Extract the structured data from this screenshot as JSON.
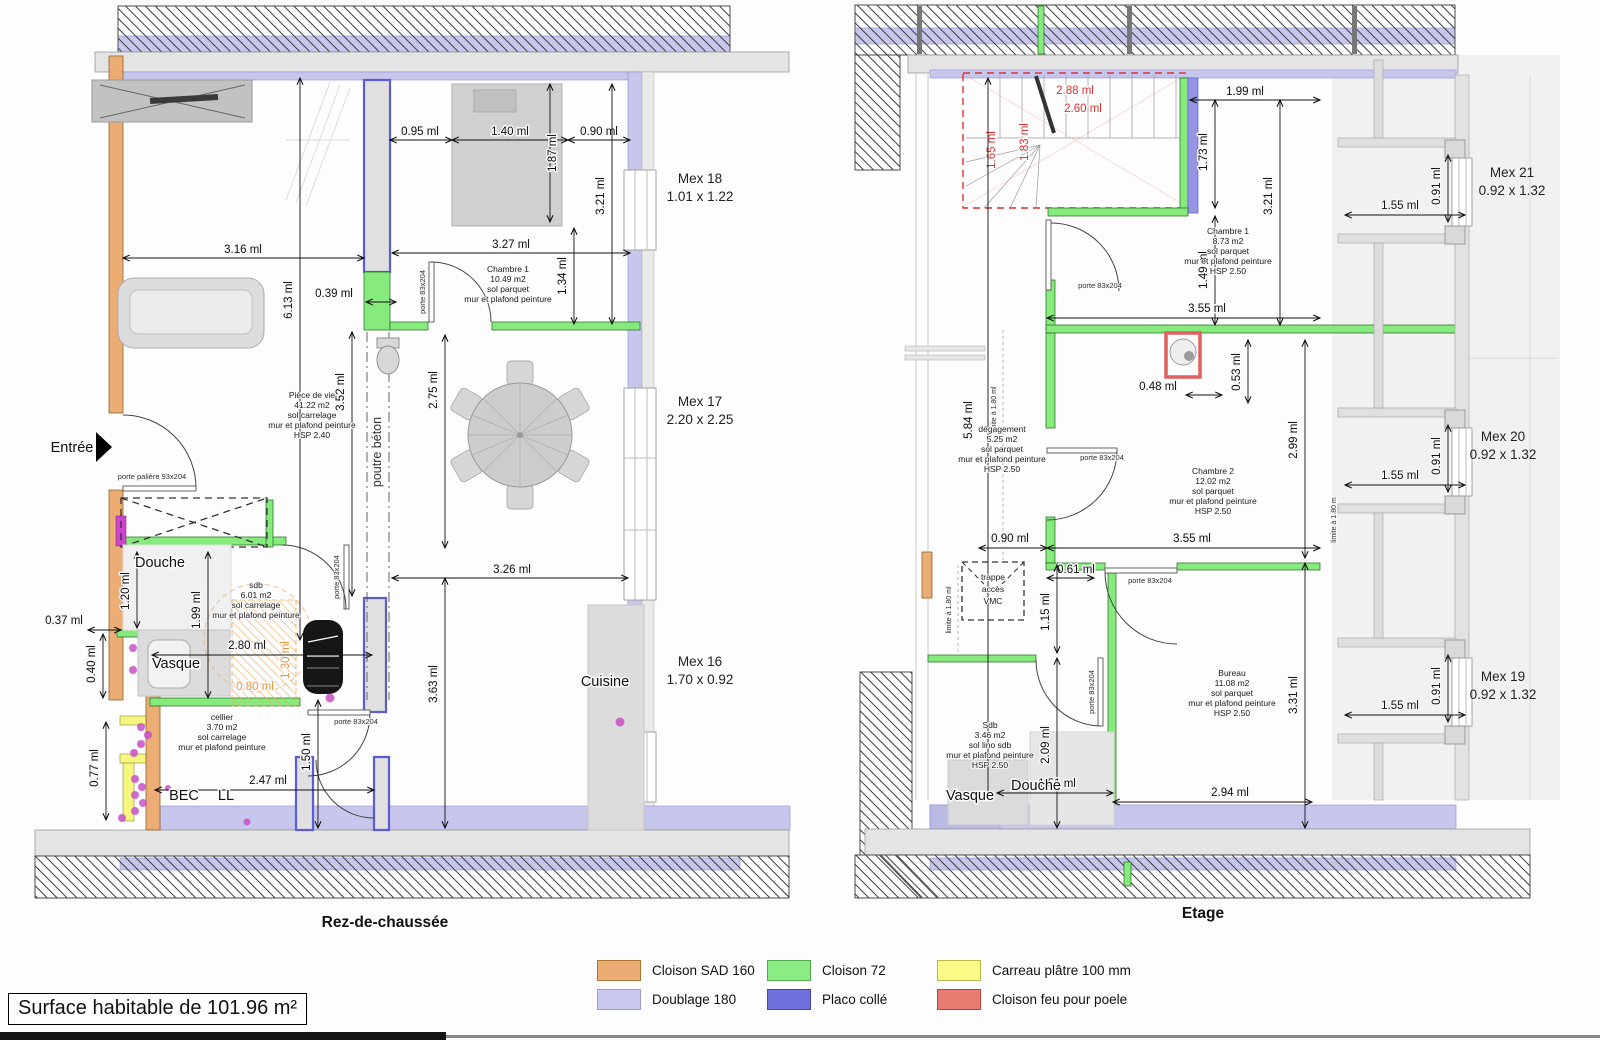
{
  "meta": {
    "surface_label": "Surface habitable de 101.96 m²"
  },
  "titles": {
    "ground": "Rez-de-chaussée",
    "floor": "Etage"
  },
  "legend": {
    "items": [
      {
        "label": "Cloison SAD 160",
        "color": "#EBAD74",
        "style": "background:#EBAD74;border:1px solid #A9772F"
      },
      {
        "label": "Doublage 180",
        "color": "#C9C9F0",
        "style": "background:#C9C9F0;border:1px solid #9B9BD0"
      },
      {
        "label": "Cloison 72",
        "color": "#8BEC83",
        "style": "background:#8BEC83;border:1px solid #4EA84E"
      },
      {
        "label": "Placo collé",
        "color": "#6F6FDE",
        "style": "background:#6F6FDE;border:1px solid #4444AA"
      },
      {
        "label": "Carreau plâtre 100 mm",
        "color": "#FAFA86",
        "style": "background:#FAFA86;border:1px solid #B9B950"
      },
      {
        "label": "Cloison feu pour poele",
        "color": "#E87B72",
        "style": "background:#E87B72;border:1px solid #B04840"
      }
    ]
  },
  "ground": {
    "labels": {
      "entree": "Entrée",
      "douche": "Douche",
      "vasque": "Vasque",
      "bec": "BEC",
      "ll": "LL",
      "cuisine": "Cuisine",
      "poutre": "poutre béton",
      "porte_paliere": "porte palière 93x204",
      "porte83": "porte 83x204"
    },
    "rooms": {
      "piece_de_vie": [
        "Pièce de vie",
        "41.22 m2",
        "sol carrelage",
        "mur et plafond peinture",
        "HSP 2.40"
      ],
      "chambre1": [
        "Chambre 1",
        "10.49 m2",
        "sol parquet",
        "mur et plafond peinture"
      ],
      "sdb": [
        "sdb",
        "6.01 m2",
        "sol carrelage",
        "mur et plafond peinture"
      ],
      "cellier": [
        "cellier",
        "3.70 m2",
        "sol carrelage",
        "mur et plafond peinture"
      ]
    },
    "windows": {
      "mex18": {
        "name": "Mex 18",
        "size": "1.01 x 1.22"
      },
      "mex17": {
        "name": "Mex 17",
        "size": "2.20 x 2.25"
      },
      "mex16": {
        "name": "Mex 16",
        "size": "1.70 x 0.92"
      }
    },
    "dims": {
      "d095": "0.95 ml",
      "d140": "1.40 ml",
      "d090": "0.90 ml",
      "d187": "1.87 ml",
      "d321": "3.21 ml",
      "d327": "3.27 ml",
      "d134": "1.34 ml",
      "d316": "3.16 ml",
      "d613": "6.13 ml",
      "d039": "0.39 ml",
      "d352": "3.52 ml",
      "d275": "2.75 ml",
      "d326": "3.26 ml",
      "d363": "3.63 ml",
      "d037": "0.37 ml",
      "d120": "1.20 ml",
      "d199": "1.99 ml",
      "d040": "0.40 ml",
      "d077": "0.77 ml",
      "d280": "2.80 ml",
      "d130": "1.30 ml",
      "d080": "0.80 ml",
      "d247": "2.47 ml",
      "d150": "1.50 ml"
    }
  },
  "floor": {
    "labels": {
      "vasque": "Vasque",
      "douche": "Douche",
      "porte83": "porte 83x204",
      "trappe1": "trappe",
      "trappe2": "accès",
      "trappe3": "VMC",
      "limite": "limite à 1.80 ml",
      "limite2": "limite à 1.80 m"
    },
    "rooms": {
      "chambre1": [
        "Chambre 1",
        "8.73 m2",
        "sol parquet",
        "mur et plafond peinture",
        "HSP 2.50"
      ],
      "degagement": [
        "dégagement",
        "5.25 m2",
        "sol parquet",
        "mur et plafond peinture",
        "HSP 2.50"
      ],
      "chambre2": [
        "Chambre 2",
        "12.02 m2",
        "sol parquet",
        "mur et plafond peinture",
        "HSP 2.50"
      ],
      "bureau": [
        "Bureau",
        "11.08 m2",
        "sol parquet",
        "mur et plafond peinture",
        "HSP 2.50"
      ],
      "sdb": [
        "Sdb",
        "3.46 m2",
        "sol lino sdb",
        "mur et plafond peinture",
        "HSP 2.50"
      ]
    },
    "windows": {
      "mex21": {
        "name": "Mex 21",
        "size": "0.92 x 1.32"
      },
      "mex20": {
        "name": "Mex 20",
        "size": "0.92 x 1.32"
      },
      "mex19": {
        "name": "Mex 19",
        "size": "0.92 x 1.32"
      }
    },
    "stairs": {
      "d288": "2.88 ml",
      "d260": "2.60 ml",
      "d165": "1.65 ml",
      "d183": "1.83 ml"
    },
    "dims": {
      "d199": "1.99 ml",
      "d173": "1.73 ml",
      "d321": "3.21 ml",
      "d149": "1.49 ml",
      "d355": "3.55 ml",
      "d048": "0.48 ml",
      "d053": "0.53 ml",
      "d299": "2.99 ml",
      "d584": "5.84 ml",
      "d090": "0.90 ml",
      "d061": "0.61 ml",
      "d115": "1.15 ml",
      "d209": "2.09 ml",
      "d151": "1.51 ml",
      "d294": "2.94 ml",
      "d331": "3.31 ml",
      "d155": "1.55 ml",
      "d091": "0.91 ml"
    }
  }
}
